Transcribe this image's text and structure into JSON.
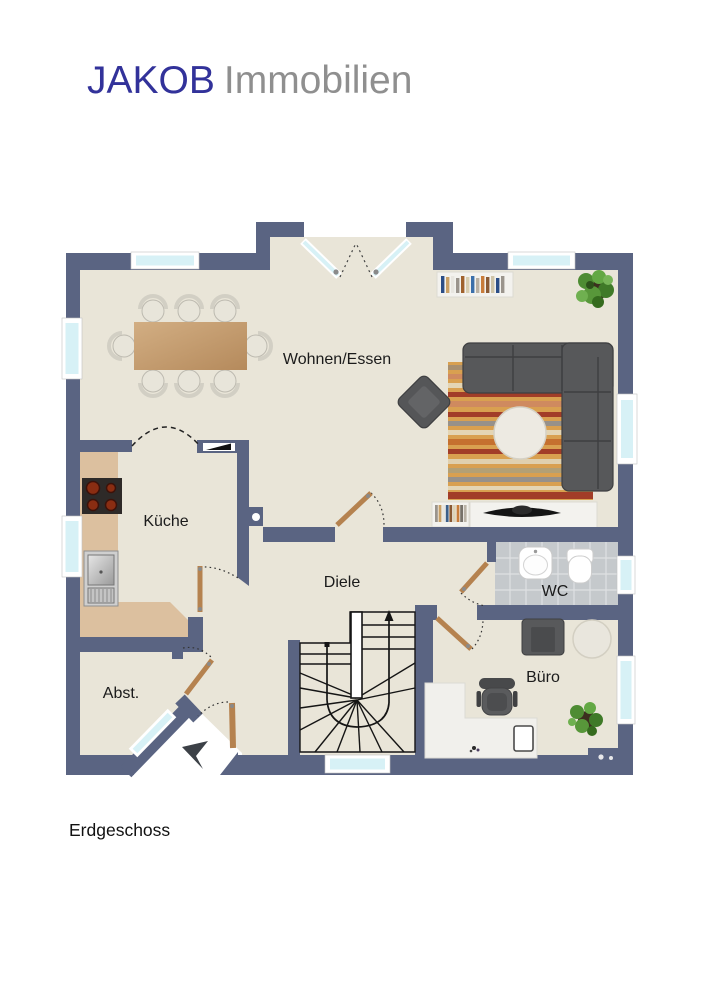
{
  "logo": {
    "primary": "JAKOB",
    "secondary": "Immobilien"
  },
  "floor_label": "Erdgeschoss",
  "rooms": {
    "living_dining": {
      "label": "Wohnen/Essen"
    },
    "kitchen": {
      "label": "Küche"
    },
    "hallway": {
      "label": "Diele"
    },
    "wc": {
      "label": "WC"
    },
    "office": {
      "label": "Büro"
    },
    "storage": {
      "label": "Abst."
    }
  },
  "colors": {
    "wall": "#5a6482",
    "floor": "#e9e5d8",
    "window_glass": "#d7f1f6",
    "tile": "#c5c9cc",
    "kitchen_counter": "#dcc09f",
    "wood_door": "#b5824f",
    "sofa": "#57585a",
    "rug_base": "#d9a050",
    "logo_primary": "#32329a",
    "logo_secondary": "#8f8f8f"
  }
}
